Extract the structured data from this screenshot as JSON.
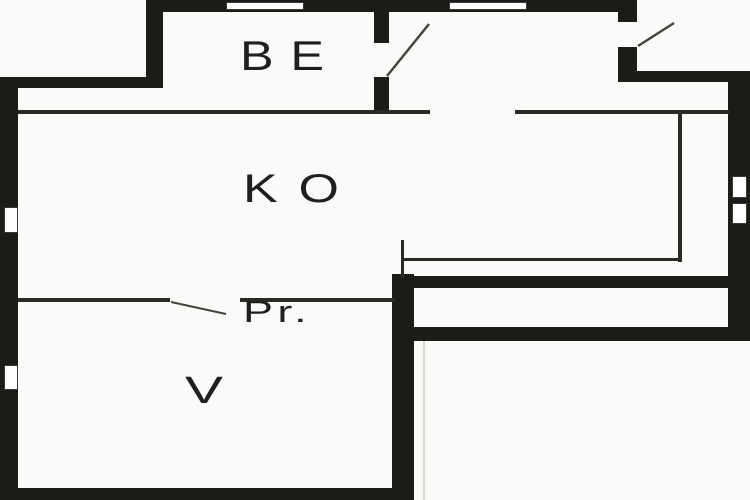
{
  "plan": {
    "type": "floor-plan",
    "rooms": [
      {
        "id": "be",
        "label": "BE"
      },
      {
        "id": "ko",
        "label": "KO"
      },
      {
        "id": "pr",
        "label": "Pr."
      },
      {
        "id": "v",
        "label": "V"
      }
    ]
  },
  "colors": {
    "wall": "#1d1b18",
    "thin_line": "#2b2926",
    "paper": "#fbfaf8",
    "window": "#ffffff",
    "label_text": "#201f1d"
  }
}
